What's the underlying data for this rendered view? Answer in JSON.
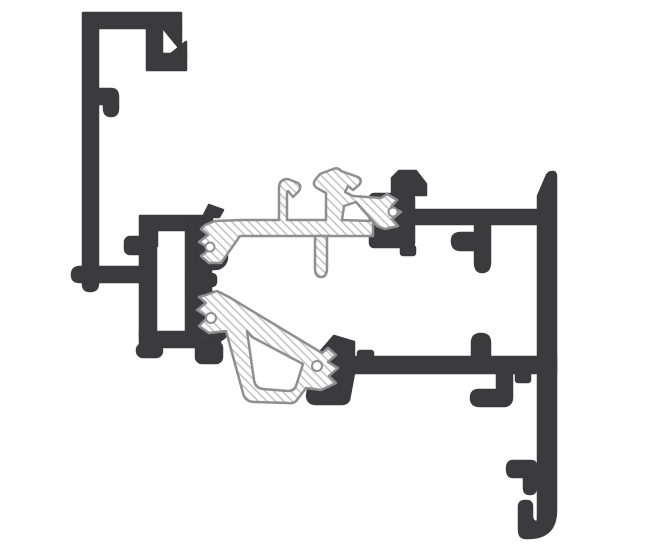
{
  "canvas": {
    "width": 648,
    "height": 545,
    "background_color": "#ffffff"
  },
  "colors": {
    "profile_dark": "#3b3b3d",
    "insulator_outline": "#8f8f8f",
    "insulator_fill": "#ffffff",
    "hatch_line": "#bdbdbd"
  },
  "drawing": {
    "kind": "technical-cross-section",
    "subject": "aluminium frame profile section with hatched insulating strips",
    "text_labels": [],
    "components": [
      {
        "id": "outer-frame-profile-left",
        "appearance": "dark solid profile"
      },
      {
        "id": "coupling-profile-center",
        "appearance": "dark solid profile with gasket lobes"
      },
      {
        "id": "sash-profile-right",
        "appearance": "dark solid profile with hooks"
      },
      {
        "id": "insulating-strip-top",
        "appearance": "white hatched strip with round holes"
      },
      {
        "id": "insulating-strut-bottom",
        "appearance": "white hatched hollow strut with round holes"
      }
    ]
  }
}
